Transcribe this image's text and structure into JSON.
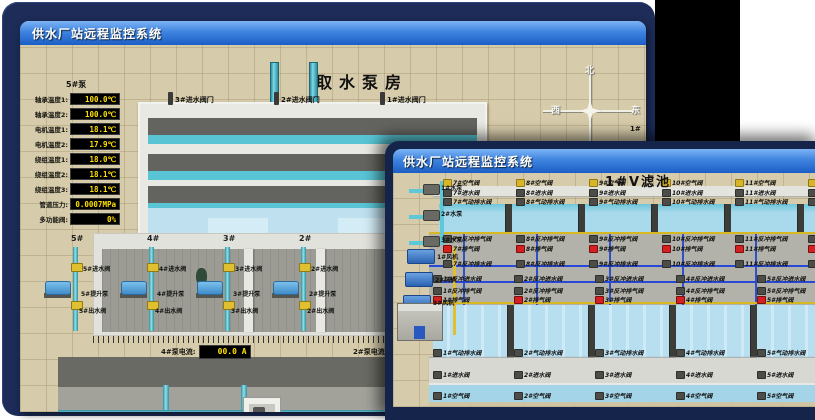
{
  "back_window": {
    "title": "供水厂站远程监控系统",
    "scene_title": "取水泵房",
    "pump_panel": {
      "header": "5#泵",
      "rows": [
        {
          "label": "轴承温度1:",
          "value": "100.0℃"
        },
        {
          "label": "轴承温度2:",
          "value": "100.0℃"
        },
        {
          "label": "电机温度1:",
          "value": "18.1℃"
        },
        {
          "label": "电机温度2:",
          "value": "17.9℃"
        },
        {
          "label": "绕组温度1:",
          "value": "18.0℃"
        },
        {
          "label": "绕组温度2:",
          "value": "18.1℃"
        },
        {
          "label": "绕组温度3:",
          "value": "18.1℃"
        },
        {
          "label": "管道压力:",
          "value": "0.0007MPa"
        },
        {
          "label": "多功能阀:",
          "value": "0%"
        }
      ]
    },
    "intake_valves": [
      "3#进水阀门",
      "2#进水阀门",
      "1#进水阀门"
    ],
    "compass": {
      "north": "北",
      "south": "南",
      "west": "西",
      "east": "东"
    },
    "side_panel": {
      "header": "1#",
      "labels": [
        "轴承温度1",
        "轴承温度2"
      ]
    },
    "bays": [
      {
        "no": "5#",
        "inlet": "5#进水阀",
        "pump": "5#提升泵",
        "outlet": "5#出水阀"
      },
      {
        "no": "4#",
        "inlet": "4#进水阀",
        "pump": "4#提升泵",
        "outlet": "4#出水阀"
      },
      {
        "no": "3#",
        "inlet": "3#进水阀",
        "pump": "3#提升泵",
        "outlet": "3#出水阀"
      },
      {
        "no": "2#",
        "inlet": "2#进水阀",
        "pump": "2#提升泵",
        "outlet": "2#出水阀"
      }
    ],
    "current_left": {
      "label": "4#泵电流:",
      "value": "00.0 A"
    },
    "current_right": {
      "label": "2#泵电流:",
      "value": ""
    },
    "flow_left": {
      "label": "1#瞬时流量:",
      "value": "0.0 m3/h"
    },
    "flow_right": {
      "label": "1#瞬时流量:",
      "value": "0.0 m3/h"
    }
  },
  "front_window": {
    "title": "供水厂站远程监控系统",
    "scene_title": "1#V滤池",
    "equipment": {
      "pumps": [
        "1#水泵",
        "2#水泵",
        "3#水泵"
      ],
      "blowers": [
        "1#风机",
        "2#风机",
        "3#风机"
      ]
    },
    "top": {
      "air": [
        "7#空气阀",
        "8#空气阀",
        "9#空气阀",
        "10#空气阀",
        "11#空气阀",
        "12#空气阀"
      ],
      "inlet": [
        "7#进水阀",
        "8#进水阀",
        "9#进水阀",
        "10#进水阀",
        "11#进水阀",
        "12#进水阀"
      ],
      "drain": [
        "7#气动排水阀",
        "8#气动排水阀",
        "9#气动排水阀",
        "10#气动排水阀",
        "11#气动排水阀",
        "12#气动排水阀"
      ],
      "bw_air": [
        "7#反冲排气阀",
        "8#反冲排气阀",
        "9#反冲排气阀",
        "10#反冲排气阀",
        "11#反冲排气阀",
        "12#反冲排气阀"
      ],
      "exhaust": [
        "7#排气阀",
        "8#排气阀",
        "9#排气阀",
        "10#排气阀",
        "11#排气阀",
        "12#排气阀"
      ],
      "bw_drain": [
        "7#反冲排水阀",
        "8#反冲排水阀",
        "9#反冲排水阀",
        "10#反冲排水阀",
        "11#反冲排水阀",
        "12#反冲排水阀"
      ]
    },
    "bottom": {
      "bw_inlet": [
        "1#反冲进水阀",
        "2#反冲进水阀",
        "3#反冲进水阀",
        "4#反冲进水阀",
        "5#反冲进水阀",
        "6#反冲进水阀"
      ],
      "bw_air": [
        "1#反冲排气阀",
        "2#反冲排气阀",
        "3#反冲排气阀",
        "4#反冲排气阀",
        "5#反冲排气阀",
        "6#反冲排气阀"
      ],
      "exhaust": [
        "1#排气阀",
        "2#排气阀",
        "3#排气阀",
        "4#排气阀",
        "5#排气阀",
        "6#排气阀"
      ],
      "drain": [
        "1#气动排水阀",
        "2#气动排水阀",
        "3#气动排水阀",
        "4#气动排水阀",
        "5#气动排水阀",
        "6#气动排水阀"
      ],
      "inlet": [
        "1#进水阀",
        "2#进水阀",
        "3#进水阀",
        "4#进水阀",
        "5#进水阀",
        "6#进水阀"
      ],
      "air": [
        "1#空气阀",
        "2#空气阀",
        "3#空气阀",
        "4#空气阀",
        "5#空气阀",
        "6#空气阀"
      ]
    }
  },
  "colors": {
    "desktop": "#1d2c58",
    "titlebar_top": "#7db4f4",
    "titlebar_bottom": "#1b5ec6",
    "led_text": "#ffe000",
    "water": "#58c4d4",
    "alarm_red": "#d42020"
  }
}
